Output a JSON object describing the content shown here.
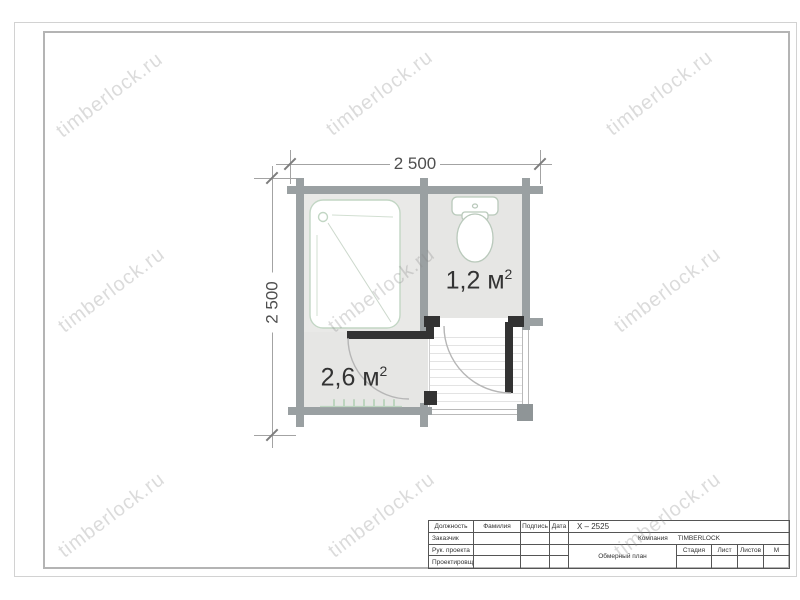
{
  "watermark": {
    "text": "timberlock.ru"
  },
  "plan": {
    "dimensions": {
      "width_label": "2 500",
      "height_label": "2 500"
    },
    "rooms": {
      "toilet": {
        "area": "1,2 м",
        "area_sup": "2"
      },
      "washroom": {
        "area": "2,6 м",
        "area_sup": "2"
      }
    },
    "colors": {
      "wall": "#9aa0a2",
      "dark_wall": "#333333",
      "room_fill": "#e7e7e5",
      "fixture_outline": "#c2d6c4"
    }
  },
  "titleblock": {
    "code": "X – 2525",
    "company_label": "Компания",
    "company_name": "TIMBERLOCK",
    "drawing_title": "Обмерный план",
    "headers": {
      "position": "Должность",
      "surname": "Фамилия",
      "signature": "Подпись",
      "date": "Дата"
    },
    "roles": {
      "customer": "Заказчик",
      "project_lead": "Рук. проекта",
      "designer": "Проектировщик"
    },
    "meta": {
      "stage": "Стадия",
      "sheet": "Лист",
      "sheets": "Листов",
      "scale": "М"
    }
  }
}
